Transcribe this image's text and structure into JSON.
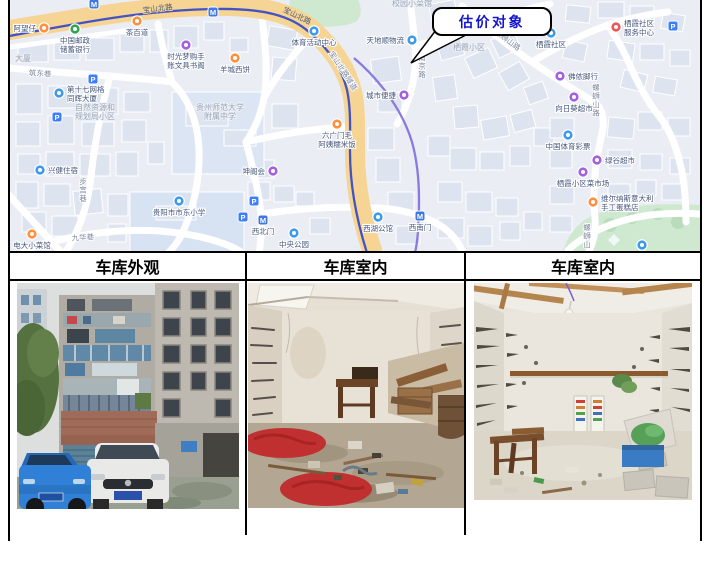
{
  "table": {
    "headers": [
      "车库外观",
      "车库室内",
      "车库室内"
    ]
  },
  "map": {
    "callout_label": "估价对象",
    "pois": [
      {
        "label": "阿望仔",
        "x": 34,
        "y": 28,
        "cat": "food",
        "pos": "left"
      },
      {
        "label": "茶百道",
        "x": 127,
        "y": 21,
        "cat": "food",
        "pos": "below"
      },
      {
        "label": "中国邮政储蓄银行",
        "lines": [
          "中国邮政",
          "储蓄银行"
        ],
        "x": 65,
        "y": 29,
        "cat": "green",
        "pos": "below"
      },
      {
        "label": "时光梦购手账文具书阁",
        "lines": [
          "时光梦购手",
          "账文具书阁"
        ],
        "x": 176,
        "y": 45,
        "cat": "shop",
        "pos": "below"
      },
      {
        "label": "羊城西饼",
        "x": 225,
        "y": 58,
        "cat": "food",
        "pos": "below"
      },
      {
        "label": "第十七网格同辉大厦",
        "lines": [
          "第十七网格",
          "同辉大厦"
        ],
        "x": 49,
        "y": 93,
        "cat": "blue",
        "pos": "right"
      },
      {
        "label": "兴健住宿",
        "x": 30,
        "y": 170,
        "cat": "blue",
        "pos": "right"
      },
      {
        "label": "电大小菜馆",
        "x": 22,
        "y": 234,
        "cat": "food",
        "pos": "below"
      },
      {
        "label": "体育活动中心",
        "x": 304,
        "y": 31,
        "cat": "blue",
        "pos": "below"
      },
      {
        "label": "天地顺物流",
        "x": 402,
        "y": 40,
        "cat": "blue",
        "pos": "left"
      },
      {
        "label": "城市便捷",
        "x": 394,
        "y": 95,
        "cat": "shop",
        "pos": "left"
      },
      {
        "label": "六广门毛阿姨糯米饭",
        "lines": [
          "六广门毛",
          "阿姨糯米饭"
        ],
        "x": 327,
        "y": 124,
        "cat": "food",
        "pos": "below"
      },
      {
        "label": "坤阁会",
        "x": 263,
        "y": 171,
        "cat": "shop",
        "pos": "left"
      },
      {
        "label": "西北门",
        "x": 253,
        "y": 220,
        "cat": "metro",
        "pos": "below"
      },
      {
        "label": "中央公园",
        "x": 284,
        "y": 233,
        "cat": "blue",
        "pos": "below"
      },
      {
        "label": "西湖公馆",
        "x": 368,
        "y": 217,
        "cat": "blue",
        "pos": "below"
      },
      {
        "label": "西南门",
        "x": 410,
        "y": 216,
        "cat": "metro",
        "pos": "below"
      },
      {
        "label": "贵阳市市东小学",
        "x": 169,
        "y": 201,
        "cat": "blue",
        "pos": "below"
      },
      {
        "label": "栖霞社区",
        "x": 541,
        "y": 33,
        "cat": "blue",
        "pos": "below"
      },
      {
        "label": "栖霞社区服务中心",
        "lines": [
          "栖霞社区",
          "服务中心"
        ],
        "x": 606,
        "y": 27,
        "cat": "red",
        "pos": "right"
      },
      {
        "label": "佛侬脚行",
        "x": 550,
        "y": 76,
        "cat": "shop",
        "pos": "right"
      },
      {
        "label": "向日葵超市",
        "x": 564,
        "y": 97,
        "cat": "shop",
        "pos": "below"
      },
      {
        "label": "中国体育彩票",
        "x": 558,
        "y": 135,
        "cat": "blue",
        "pos": "below"
      },
      {
        "label": "绿谷超市",
        "x": 587,
        "y": 160,
        "cat": "shop",
        "pos": "right"
      },
      {
        "label": "栖霞小区菜市场",
        "x": 573,
        "y": 172,
        "cat": "shop",
        "pos": "below"
      },
      {
        "label": "维尔纳斯意大利手工蛋糕店",
        "lines": [
          "维尔纳斯意大利",
          "手工蛋糕店"
        ],
        "x": 583,
        "y": 202,
        "cat": "food",
        "pos": "right"
      },
      {
        "label": "",
        "x": 632,
        "y": 245,
        "cat": "blue",
        "pos": "below"
      }
    ],
    "parking": [
      {
        "x": 83,
        "y": 79
      },
      {
        "x": 47,
        "y": 117
      },
      {
        "x": 244,
        "y": 201
      },
      {
        "x": 663,
        "y": 26
      },
      {
        "x": 233,
        "y": 217
      }
    ],
    "transit": [
      {
        "x": 84,
        "y": 4
      },
      {
        "x": 203,
        "y": 12
      }
    ],
    "area_labels": [
      {
        "lines": [
          "自然资源和",
          "规划局小区"
        ],
        "x": 85,
        "y": 110
      },
      {
        "lines": [
          "贵州师范大学",
          "附属中学"
        ],
        "x": 210,
        "y": 110
      },
      {
        "lines": [
          "栖霞小区"
        ],
        "x": 459,
        "y": 50
      },
      {
        "lines": [
          "校园小菜馆"
        ],
        "x": 402,
        "y": 6
      },
      {
        "lines": [
          "大厦"
        ],
        "x": 13,
        "y": 61
      }
    ],
    "road_labels": [
      {
        "text": "宝山北路",
        "x": 148,
        "y": 11,
        "rot": -7,
        "major": true
      },
      {
        "text": "宝山北路",
        "x": 286,
        "y": 18,
        "rot": 26,
        "major": true
      },
      {
        "text": "宝山北路隧道",
        "x": 331,
        "y": 72,
        "rot": 57
      },
      {
        "text": "筑东巷",
        "x": 30,
        "y": 76,
        "rot": 3
      },
      {
        "text": "九华巷",
        "x": 73,
        "y": 240,
        "rot": -4
      },
      {
        "text": "步宫巷",
        "x": 73,
        "y": 184,
        "vertical": true
      },
      {
        "text": "南京路",
        "x": 412,
        "y": 60,
        "vertical": true
      },
      {
        "text": "螺蛳山路",
        "x": 496,
        "y": 42,
        "rot": 37
      },
      {
        "text": "螺蛳山路",
        "x": 586,
        "y": 90,
        "vertical": true
      },
      {
        "text": "螺蛳山",
        "x": 577,
        "y": 230,
        "vertical": true
      }
    ],
    "colors": {
      "food": "#ff8f3b",
      "shop": "#a35fe0",
      "blue": "#3d9ae8",
      "green": "#2ea44f",
      "red": "#f05555",
      "parking": "#3d7eff",
      "metro": "#3f78e0",
      "main_road": "#f6d493",
      "metro_line": "#4353c4",
      "metro_line2": "#8a7ae0",
      "map_bg": "#eaedf4",
      "building": "#dde3ef",
      "park": "#cfe8d0",
      "callout_text": "#1414cc"
    }
  }
}
